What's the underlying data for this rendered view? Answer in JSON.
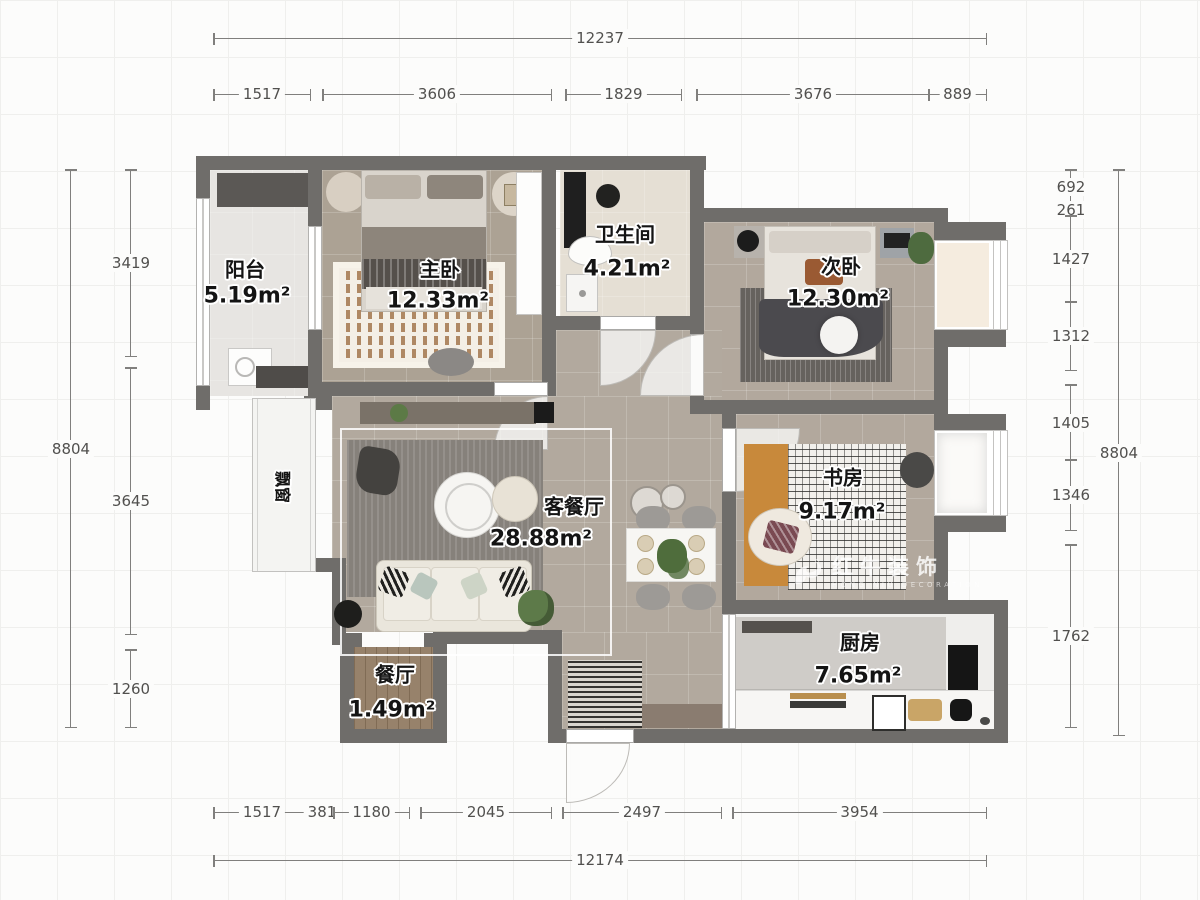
{
  "rooms": {
    "balcony": {
      "name": "阳台",
      "area": "5.19m²"
    },
    "master_bedroom": {
      "name": "主卧",
      "area": "12.33m²"
    },
    "bathroom": {
      "name": "卫生间",
      "area": "4.21m²"
    },
    "second_bedroom": {
      "name": "次卧",
      "area": "12.30m²"
    },
    "study": {
      "name": "书房",
      "area": "9.17m²"
    },
    "living_dining": {
      "name": "客餐厅",
      "area": "28.88m²"
    },
    "dining_nook": {
      "name": "餐厅",
      "area": "1.49m²"
    },
    "kitchen": {
      "name": "厨房",
      "area": "7.65m²"
    },
    "bay_window": {
      "name": "飘窗"
    }
  },
  "dimensions": {
    "top": {
      "total": "12237",
      "segments": [
        "1517",
        "3606",
        "1829",
        "3676",
        "889"
      ]
    },
    "bottom": {
      "total": "12174",
      "segments": [
        "1517",
        "381",
        "1180",
        "2045",
        "2497",
        "3954"
      ]
    },
    "left": {
      "total": "8804",
      "segments": [
        "3419",
        "3645",
        "1260"
      ]
    },
    "right": {
      "total": "8804",
      "segments": [
        "692",
        "261",
        "1427",
        "1312",
        "1405",
        "1346",
        "1762"
      ]
    }
  },
  "watermark": {
    "brand": "红牛装饰",
    "tagline": "HONG NIU DECORATION"
  },
  "colors": {
    "wall": "#6f6d6a",
    "floor_tile": "#b2a89d",
    "bath_tile": "#e5dfd4",
    "balcony_tile": "#e7e5e2",
    "wood": "#97826b",
    "study_mat": "#c8893b",
    "dim_line": "#807f7d",
    "label_text": "#141414"
  }
}
